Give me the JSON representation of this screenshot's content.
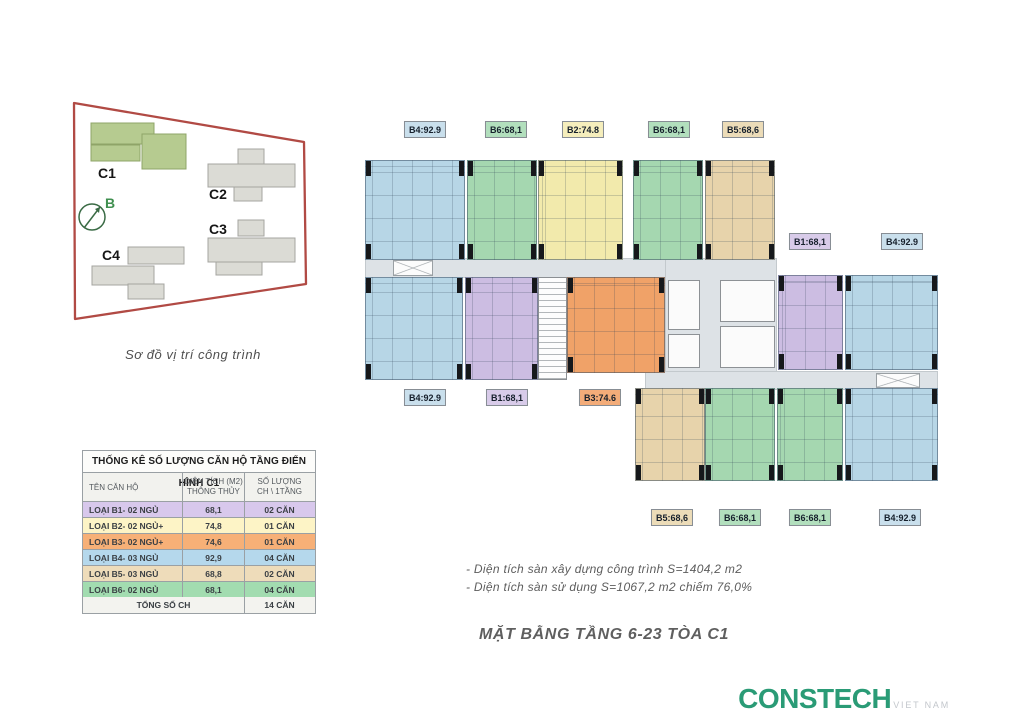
{
  "site": {
    "caption": "Sơ đồ vị trí công trình",
    "north_label": "B",
    "boundary_color": "#b14a44",
    "highlight_color": "#b6cb90",
    "buildings": [
      {
        "id": "C1",
        "highlighted": true
      },
      {
        "id": "C2",
        "highlighted": false
      },
      {
        "id": "C3",
        "highlighted": false
      },
      {
        "id": "C4",
        "highlighted": false
      }
    ]
  },
  "colors": {
    "unit": {
      "blue": "#b7d6e6",
      "green": "#a5d7b0",
      "yellow": "#f2eaac",
      "tan": "#e7d3ab",
      "purple": "#ccbde2",
      "orange": "#f0a268"
    },
    "label": {
      "blue": "#c9dfec",
      "green": "#b2dfbd",
      "yellow": "#f5eebc",
      "tan": "#ecdcb8",
      "purple": "#d8cbe9",
      "orange": "#f3ac79"
    }
  },
  "plan": {
    "corridors": [
      {
        "x": 365,
        "y": 258,
        "w": 410,
        "h": 20
      },
      {
        "x": 665,
        "y": 258,
        "w": 112,
        "h": 132
      },
      {
        "x": 645,
        "y": 371,
        "w": 293,
        "h": 19
      }
    ],
    "units": [
      {
        "type": "B4",
        "c": "blue",
        "x": 365,
        "y": 160,
        "w": 100,
        "h": 100
      },
      {
        "type": "B6",
        "c": "green",
        "x": 467,
        "y": 160,
        "w": 70,
        "h": 100
      },
      {
        "type": "B2",
        "c": "yellow",
        "x": 538,
        "y": 160,
        "w": 85,
        "h": 100
      },
      {
        "type": "B6",
        "c": "green",
        "x": 633,
        "y": 160,
        "w": 70,
        "h": 100
      },
      {
        "type": "B5",
        "c": "tan",
        "x": 705,
        "y": 160,
        "w": 70,
        "h": 100
      },
      {
        "type": "B4",
        "c": "blue",
        "x": 365,
        "y": 277,
        "w": 98,
        "h": 103
      },
      {
        "type": "B1",
        "c": "purple",
        "x": 465,
        "y": 277,
        "w": 73,
        "h": 103
      },
      {
        "type": "B3",
        "c": "orange",
        "x": 567,
        "y": 277,
        "w": 98,
        "h": 96
      },
      {
        "type": "B1",
        "c": "purple",
        "x": 778,
        "y": 275,
        "w": 65,
        "h": 95
      },
      {
        "type": "B4",
        "c": "blue",
        "x": 845,
        "y": 275,
        "w": 93,
        "h": 95
      },
      {
        "type": "B5",
        "c": "tan",
        "x": 635,
        "y": 388,
        "w": 70,
        "h": 93
      },
      {
        "type": "B6",
        "c": "green",
        "x": 705,
        "y": 388,
        "w": 70,
        "h": 93
      },
      {
        "type": "B6",
        "c": "green",
        "x": 777,
        "y": 388,
        "w": 66,
        "h": 93
      },
      {
        "type": "B4",
        "c": "blue",
        "x": 845,
        "y": 388,
        "w": 93,
        "h": 93
      }
    ],
    "stairs": [
      {
        "x": 538,
        "y": 277,
        "w": 29,
        "h": 103
      }
    ],
    "core_rooms": [
      {
        "x": 668,
        "y": 280,
        "w": 32,
        "h": 50
      },
      {
        "x": 668,
        "y": 334,
        "w": 32,
        "h": 34
      },
      {
        "x": 720,
        "y": 280,
        "w": 55,
        "h": 42
      },
      {
        "x": 720,
        "y": 326,
        "w": 55,
        "h": 42
      }
    ],
    "xboxes": [
      {
        "x": 393,
        "y": 260,
        "w": 40,
        "h": 16
      },
      {
        "x": 876,
        "y": 373,
        "w": 44,
        "h": 15
      }
    ],
    "labels": [
      {
        "text": "B4:92.9",
        "c": "blue",
        "cx": 425,
        "y": 121
      },
      {
        "text": "B6:68,1",
        "c": "green",
        "cx": 506,
        "y": 121
      },
      {
        "text": "B2:74.8",
        "c": "yellow",
        "cx": 583,
        "y": 121
      },
      {
        "text": "B6:68,1",
        "c": "green",
        "cx": 669,
        "y": 121
      },
      {
        "text": "B5:68,6",
        "c": "tan",
        "cx": 743,
        "y": 121
      },
      {
        "text": "B1:68,1",
        "c": "purple",
        "cx": 810,
        "y": 233
      },
      {
        "text": "B4:92.9",
        "c": "blue",
        "cx": 902,
        "y": 233
      },
      {
        "text": "B4:92.9",
        "c": "blue",
        "cx": 425,
        "y": 389
      },
      {
        "text": "B1:68,1",
        "c": "purple",
        "cx": 507,
        "y": 389
      },
      {
        "text": "B3:74.6",
        "c": "orange",
        "cx": 600,
        "y": 389
      },
      {
        "text": "B5:68,6",
        "c": "tan",
        "cx": 672,
        "y": 509
      },
      {
        "text": "B6:68,1",
        "c": "green",
        "cx": 740,
        "y": 509
      },
      {
        "text": "B6:68,1",
        "c": "green",
        "cx": 810,
        "y": 509
      },
      {
        "text": "B4:92.9",
        "c": "blue",
        "cx": 900,
        "y": 509
      }
    ]
  },
  "table": {
    "title": "THỐNG KÊ SỐ LƯỢNG CĂN HỘ TẦNG ĐIỂN HÌNH C1",
    "columns": [
      "TÊN CĂN HỘ",
      "DIỆN TÍCH (M2)\nTHÔNG THỦY",
      "SỐ LƯỢNG\nCH \\ 1TẦNG"
    ],
    "rows": [
      {
        "name": "LOẠI B1- 02 NGỦ",
        "area": "68,1",
        "count": "02 CĂN",
        "color": "#d8c8ec"
      },
      {
        "name": "LOẠI B2- 02 NGỦ+",
        "area": "74,8",
        "count": "01 CĂN",
        "color": "#fdf4c6"
      },
      {
        "name": "LOẠI B3- 02 NGỦ+",
        "area": "74,6",
        "count": "01 CĂN",
        "color": "#f7b077"
      },
      {
        "name": "LOẠI B4- 03 NGỦ",
        "area": "92,9",
        "count": "04 CĂN",
        "color": "#b5d8ec"
      },
      {
        "name": "LOẠI B5- 03 NGỦ",
        "area": "68,8",
        "count": "02 CĂN",
        "color": "#eedcba"
      },
      {
        "name": "LOẠI B6- 02 NGỦ",
        "area": "68,1",
        "count": "04 CĂN",
        "color": "#a2dcb0"
      }
    ],
    "total_label": "TỔNG SỐ CH",
    "total_value": "14 CĂN"
  },
  "notes": [
    "- Diện tích sàn xây dựng công trình S=1404,2 m2",
    "- Diện tích sàn sử dụng S=1067,2 m2 chiếm 76,0%"
  ],
  "title": "MẶT BẰNG TẦNG 6-23 TÒA C1",
  "logo": {
    "text": "CONSTECH",
    "country": "VIET NAM"
  }
}
